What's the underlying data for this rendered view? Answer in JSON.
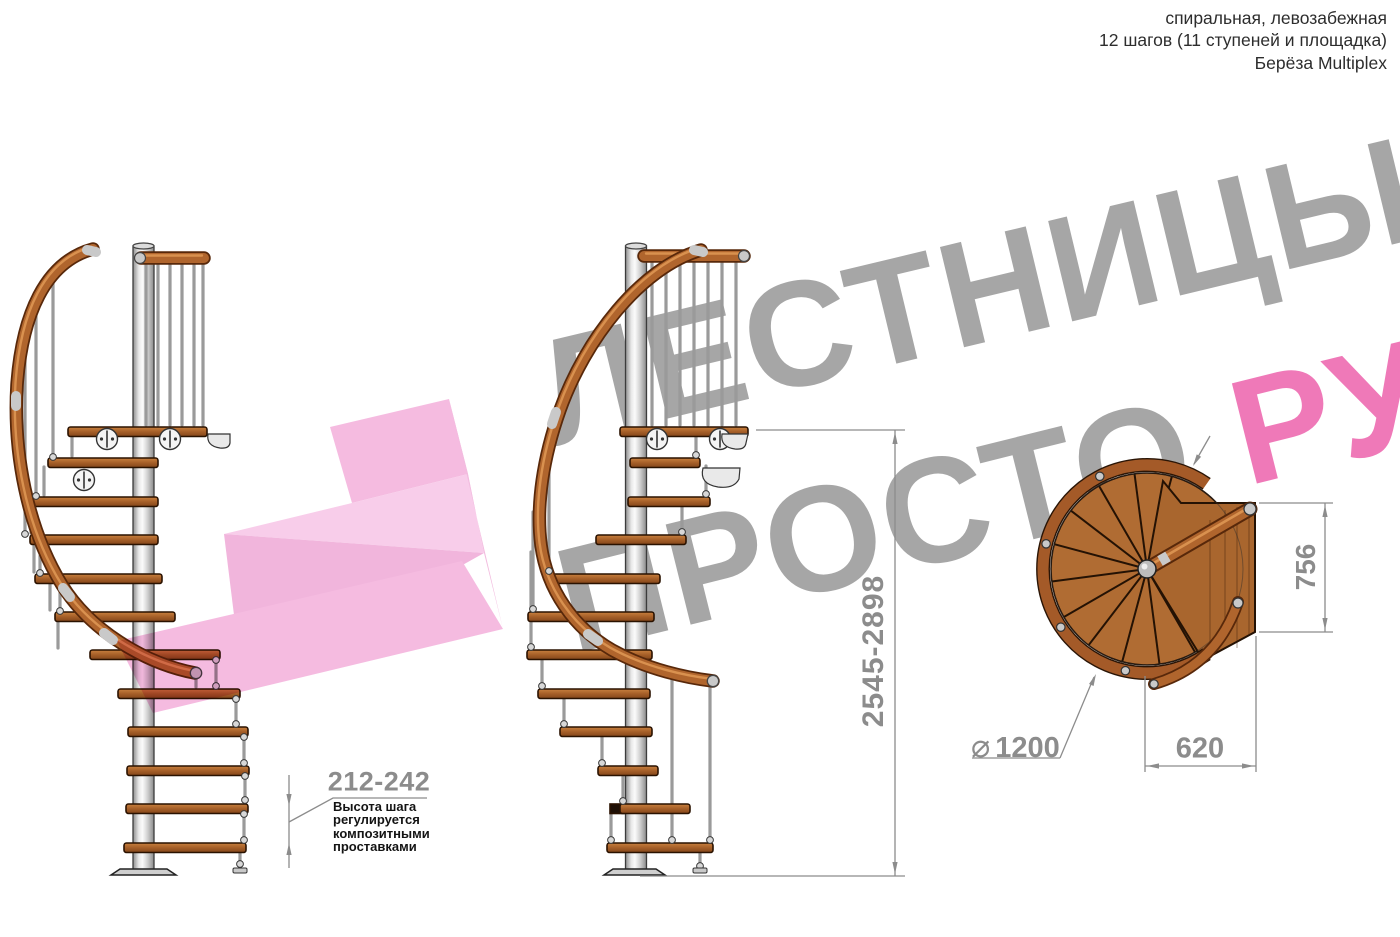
{
  "header": {
    "line1": "спиральная, левозабежная",
    "line2": "12 шагов (11 ступеней и площадка)",
    "line3": "Берёза Multiplex"
  },
  "watermark": {
    "line1": "ЛЕСТНИЦЫ",
    "line2": "ПРОСТО ",
    "line2_accent": "РУ",
    "accent_color": "#ee6eb2",
    "gray_color": "#9a9a9a"
  },
  "dimensions": {
    "total_height": "2545-2898",
    "step_height": "212-242",
    "diameter_symbol": "⌀",
    "diameter_value": "1200",
    "landing_depth": "756",
    "landing_width": "620"
  },
  "annotations": {
    "step_note_lines": [
      "Высота шага",
      "регулируется",
      "композитными",
      "проставками"
    ]
  },
  "colors": {
    "wood": "#a9622a",
    "wood_dark": "#58280a",
    "steel": "#c9c9c9",
    "dimension_gray": "#8c8c8c",
    "pink_watermark": "#f2a8d8"
  }
}
